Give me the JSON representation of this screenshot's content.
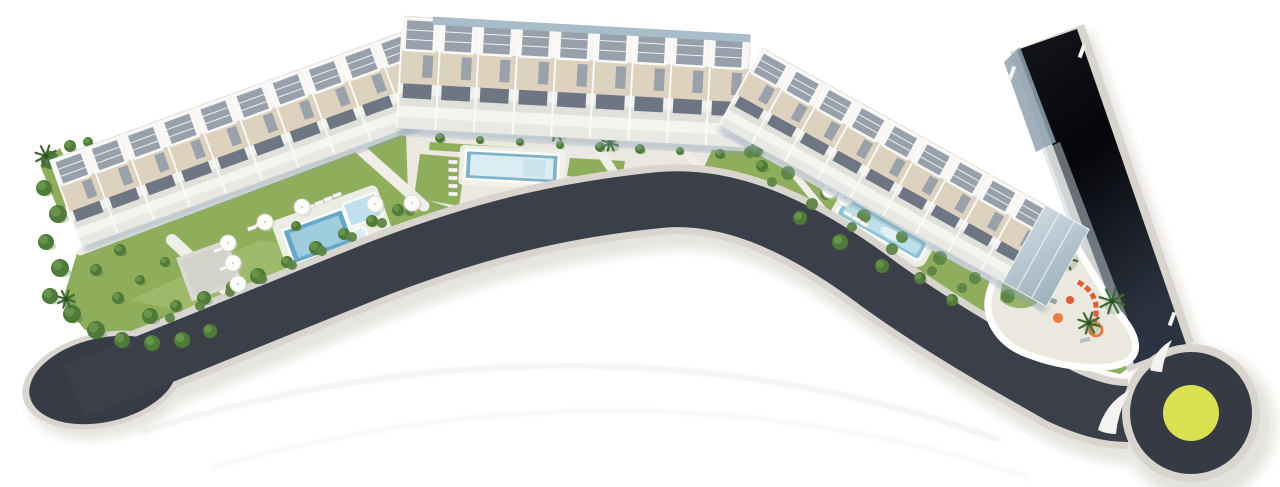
{
  "title": "aerial-site-plan-rendering",
  "canvas": {
    "width": 1280,
    "height": 487
  },
  "colors": {
    "background": "#ffffff",
    "road": "#3a3f49",
    "road_bulb": "#363b45",
    "strip_dark1": "#14161d",
    "strip_dark2": "#05060a",
    "strip_dark3": "#2c3340",
    "curb": "#d8d5cf",
    "soft_shadow": "#e2e0da",
    "grass": "#8fae5c",
    "grass_light": "#a7c474",
    "grass_dark": "#678f41",
    "tree": "#4f7b39",
    "tree_light": "#6f9c4e",
    "tree_shadow": "#3e5e2e",
    "palm": "#3f6b33",
    "hedge": "#5d8544",
    "pavement": "#eae8e1",
    "path": "#f0eee8",
    "terrace_gray": "#dad9d3",
    "pool_deep": "#66a9c6",
    "pool_mid": "#8cc3d6",
    "pool_inner": "#a9d4e4",
    "pool_pale": "#d9edf3",
    "deck": "#f1f0ea",
    "building_white": "#f7f6f3",
    "building_beige": "#ddd2bd",
    "building_slat": "#97a0ab",
    "building_stair": "#99a1ab",
    "building_recess": "#6d7682",
    "building_line": "#d9d9d5",
    "glass_blue": "#a9bcc9",
    "glass_light": "#cdd9e1",
    "wall_white": "#fdfdfc",
    "island_white": "#f4f3ef",
    "roundabout_center": "#d9e14e",
    "playground_orange": "#e25c2e",
    "playground_orange2": "#ef7a3a",
    "umbrella": "#fbfbf9",
    "lounger": "#fafaf8"
  },
  "scene": {
    "buildings": [
      {
        "name": "block-a-west",
        "x": 50,
        "y": 160,
        "rot": -20,
        "len": 385,
        "depth": 92,
        "units": 10,
        "glass_top": false,
        "glass_end": false
      },
      {
        "name": "block-b-center",
        "x": 403,
        "y": 16,
        "rot": 3.2,
        "len": 348,
        "depth": 112,
        "units": 9,
        "glass_top": true,
        "glass_end": false
      },
      {
        "name": "block-c-east",
        "x": 762,
        "y": 48,
        "rot": 29,
        "len": 374,
        "depth": 88,
        "units": 10,
        "glass_top": false,
        "glass_end": true
      }
    ],
    "trees": [
      [
        50,
        160,
        9
      ],
      [
        44,
        188,
        8
      ],
      [
        58,
        214,
        9
      ],
      [
        46,
        242,
        8
      ],
      [
        60,
        268,
        9
      ],
      [
        50,
        296,
        8
      ],
      [
        72,
        314,
        9
      ],
      [
        96,
        330,
        9
      ],
      [
        122,
        340,
        8
      ],
      [
        152,
        343,
        8
      ],
      [
        182,
        340,
        8
      ],
      [
        210,
        331,
        7
      ],
      [
        70,
        146,
        6
      ],
      [
        88,
        142,
        5
      ],
      [
        150,
        316,
        8
      ],
      [
        176,
        306,
        6
      ],
      [
        204,
        298,
        7
      ],
      [
        232,
        287,
        6
      ],
      [
        258,
        276,
        8
      ],
      [
        287,
        262,
        6
      ],
      [
        316,
        248,
        7
      ],
      [
        344,
        234,
        6
      ],
      [
        372,
        221,
        6
      ],
      [
        398,
        210,
        6
      ],
      [
        118,
        298,
        6
      ],
      [
        140,
        280,
        5
      ],
      [
        165,
        262,
        5
      ],
      [
        296,
        226,
        5
      ],
      [
        120,
        250,
        6
      ],
      [
        96,
        270,
        6
      ],
      [
        394,
        126,
        6
      ],
      [
        440,
        138,
        5
      ],
      [
        480,
        140,
        4
      ],
      [
        520,
        142,
        4
      ],
      [
        560,
        145,
        4
      ],
      [
        600,
        147,
        5
      ],
      [
        640,
        149,
        5
      ],
      [
        680,
        151,
        4
      ],
      [
        720,
        154,
        5
      ],
      [
        756,
        150,
        7
      ],
      [
        762,
        166,
        6
      ],
      [
        744,
        132,
        5
      ],
      [
        800,
        218,
        7
      ],
      [
        840,
        242,
        8
      ],
      [
        882,
        266,
        7
      ],
      [
        920,
        278,
        6
      ],
      [
        952,
        300,
        6
      ]
    ],
    "hedges": [
      [
        750,
        152,
        6
      ],
      [
        788,
        173,
        7
      ],
      [
        826,
        194,
        6
      ],
      [
        864,
        216,
        7
      ],
      [
        902,
        237,
        6
      ],
      [
        940,
        258,
        7
      ],
      [
        975,
        278,
        6
      ],
      [
        1008,
        296,
        7
      ],
      [
        772,
        182,
        5
      ],
      [
        812,
        204,
        6
      ],
      [
        852,
        227,
        5
      ],
      [
        892,
        249,
        6
      ],
      [
        932,
        271,
        5
      ],
      [
        962,
        288,
        5
      ],
      [
        170,
        318,
        5
      ],
      [
        200,
        306,
        5
      ],
      [
        230,
        292,
        5
      ],
      [
        262,
        279,
        5
      ],
      [
        292,
        265,
        5
      ],
      [
        322,
        251,
        5
      ],
      [
        352,
        237,
        5
      ],
      [
        382,
        223,
        5
      ],
      [
        410,
        211,
        5
      ]
    ],
    "palms": [
      [
        420,
        111,
        12
      ],
      [
        556,
        131,
        10
      ],
      [
        610,
        143,
        8
      ],
      [
        740,
        110,
        13
      ],
      [
        46,
        156,
        11
      ],
      [
        66,
        299,
        9
      ],
      [
        1002,
        247,
        14
      ],
      [
        1064,
        257,
        14
      ],
      [
        1112,
        301,
        13
      ],
      [
        1050,
        273,
        10
      ],
      [
        1089,
        323,
        11
      ]
    ],
    "umbrellas": [
      [
        265,
        222
      ],
      [
        228,
        243
      ],
      [
        233,
        263
      ],
      [
        238,
        284
      ],
      [
        302,
        207
      ],
      [
        375,
        204
      ],
      [
        412,
        203
      ],
      [
        830,
        190
      ],
      [
        845,
        198
      ]
    ],
    "loungers": [
      [
        453,
        162,
        3
      ],
      [
        453,
        170,
        3
      ],
      [
        453,
        178,
        3
      ],
      [
        453,
        186,
        3
      ],
      [
        453,
        194,
        3
      ],
      [
        310,
        207,
        -20
      ],
      [
        319,
        203,
        -20
      ],
      [
        328,
        199,
        -20
      ],
      [
        337,
        195,
        -20
      ],
      [
        252,
        228,
        -20
      ],
      [
        260,
        224,
        -20
      ],
      [
        218,
        250,
        -20
      ],
      [
        224,
        268,
        -20
      ],
      [
        848,
        214,
        29
      ],
      [
        856,
        219,
        29
      ],
      [
        864,
        224,
        29
      ]
    ],
    "roundabout": {
      "cx": 1191,
      "cy": 413,
      "curb_r": 69,
      "ring_r": 61,
      "center_r": 28
    }
  }
}
